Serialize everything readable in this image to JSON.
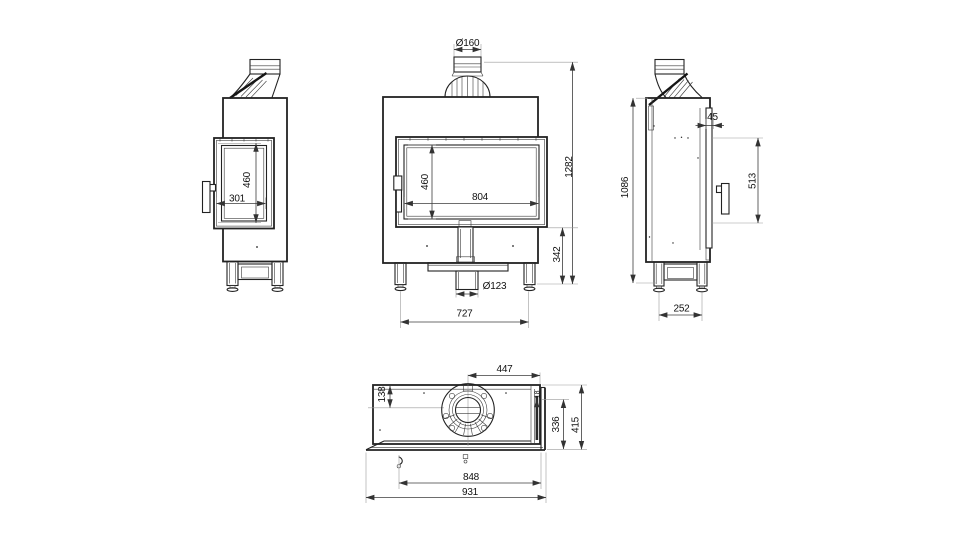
{
  "drawing_type": "fireplace-insert-technical-drawing",
  "colors": {
    "background": "#ffffff",
    "outline": "#222222",
    "dimension_line": "#3c3c3c",
    "extension_line": "#9b9b9b",
    "label_text": "#111111",
    "side_glass_fill": "#2a2a2a"
  },
  "views": {
    "left_side": {
      "dims": {
        "glass_height": "460",
        "glass_width": "301"
      }
    },
    "front": {
      "dims": {
        "flue_diameter": "Ø160",
        "glass_height": "460",
        "glass_width": "804",
        "overall_height": "1282",
        "plinth_height": "342",
        "inlet_diameter": "Ø123",
        "leg_spacing": "727"
      }
    },
    "right_side": {
      "dims": {
        "overall_height": "1086",
        "flue_front_offset": "45",
        "door_height": "513",
        "leg_spacing": "252"
      }
    },
    "top": {
      "dims": {
        "flue_to_right": "447",
        "flue_to_back": "138",
        "glass_offset": "18",
        "body_depth": "336",
        "overall_depth": "415",
        "body_width": "848",
        "overall_width": "931"
      }
    }
  }
}
